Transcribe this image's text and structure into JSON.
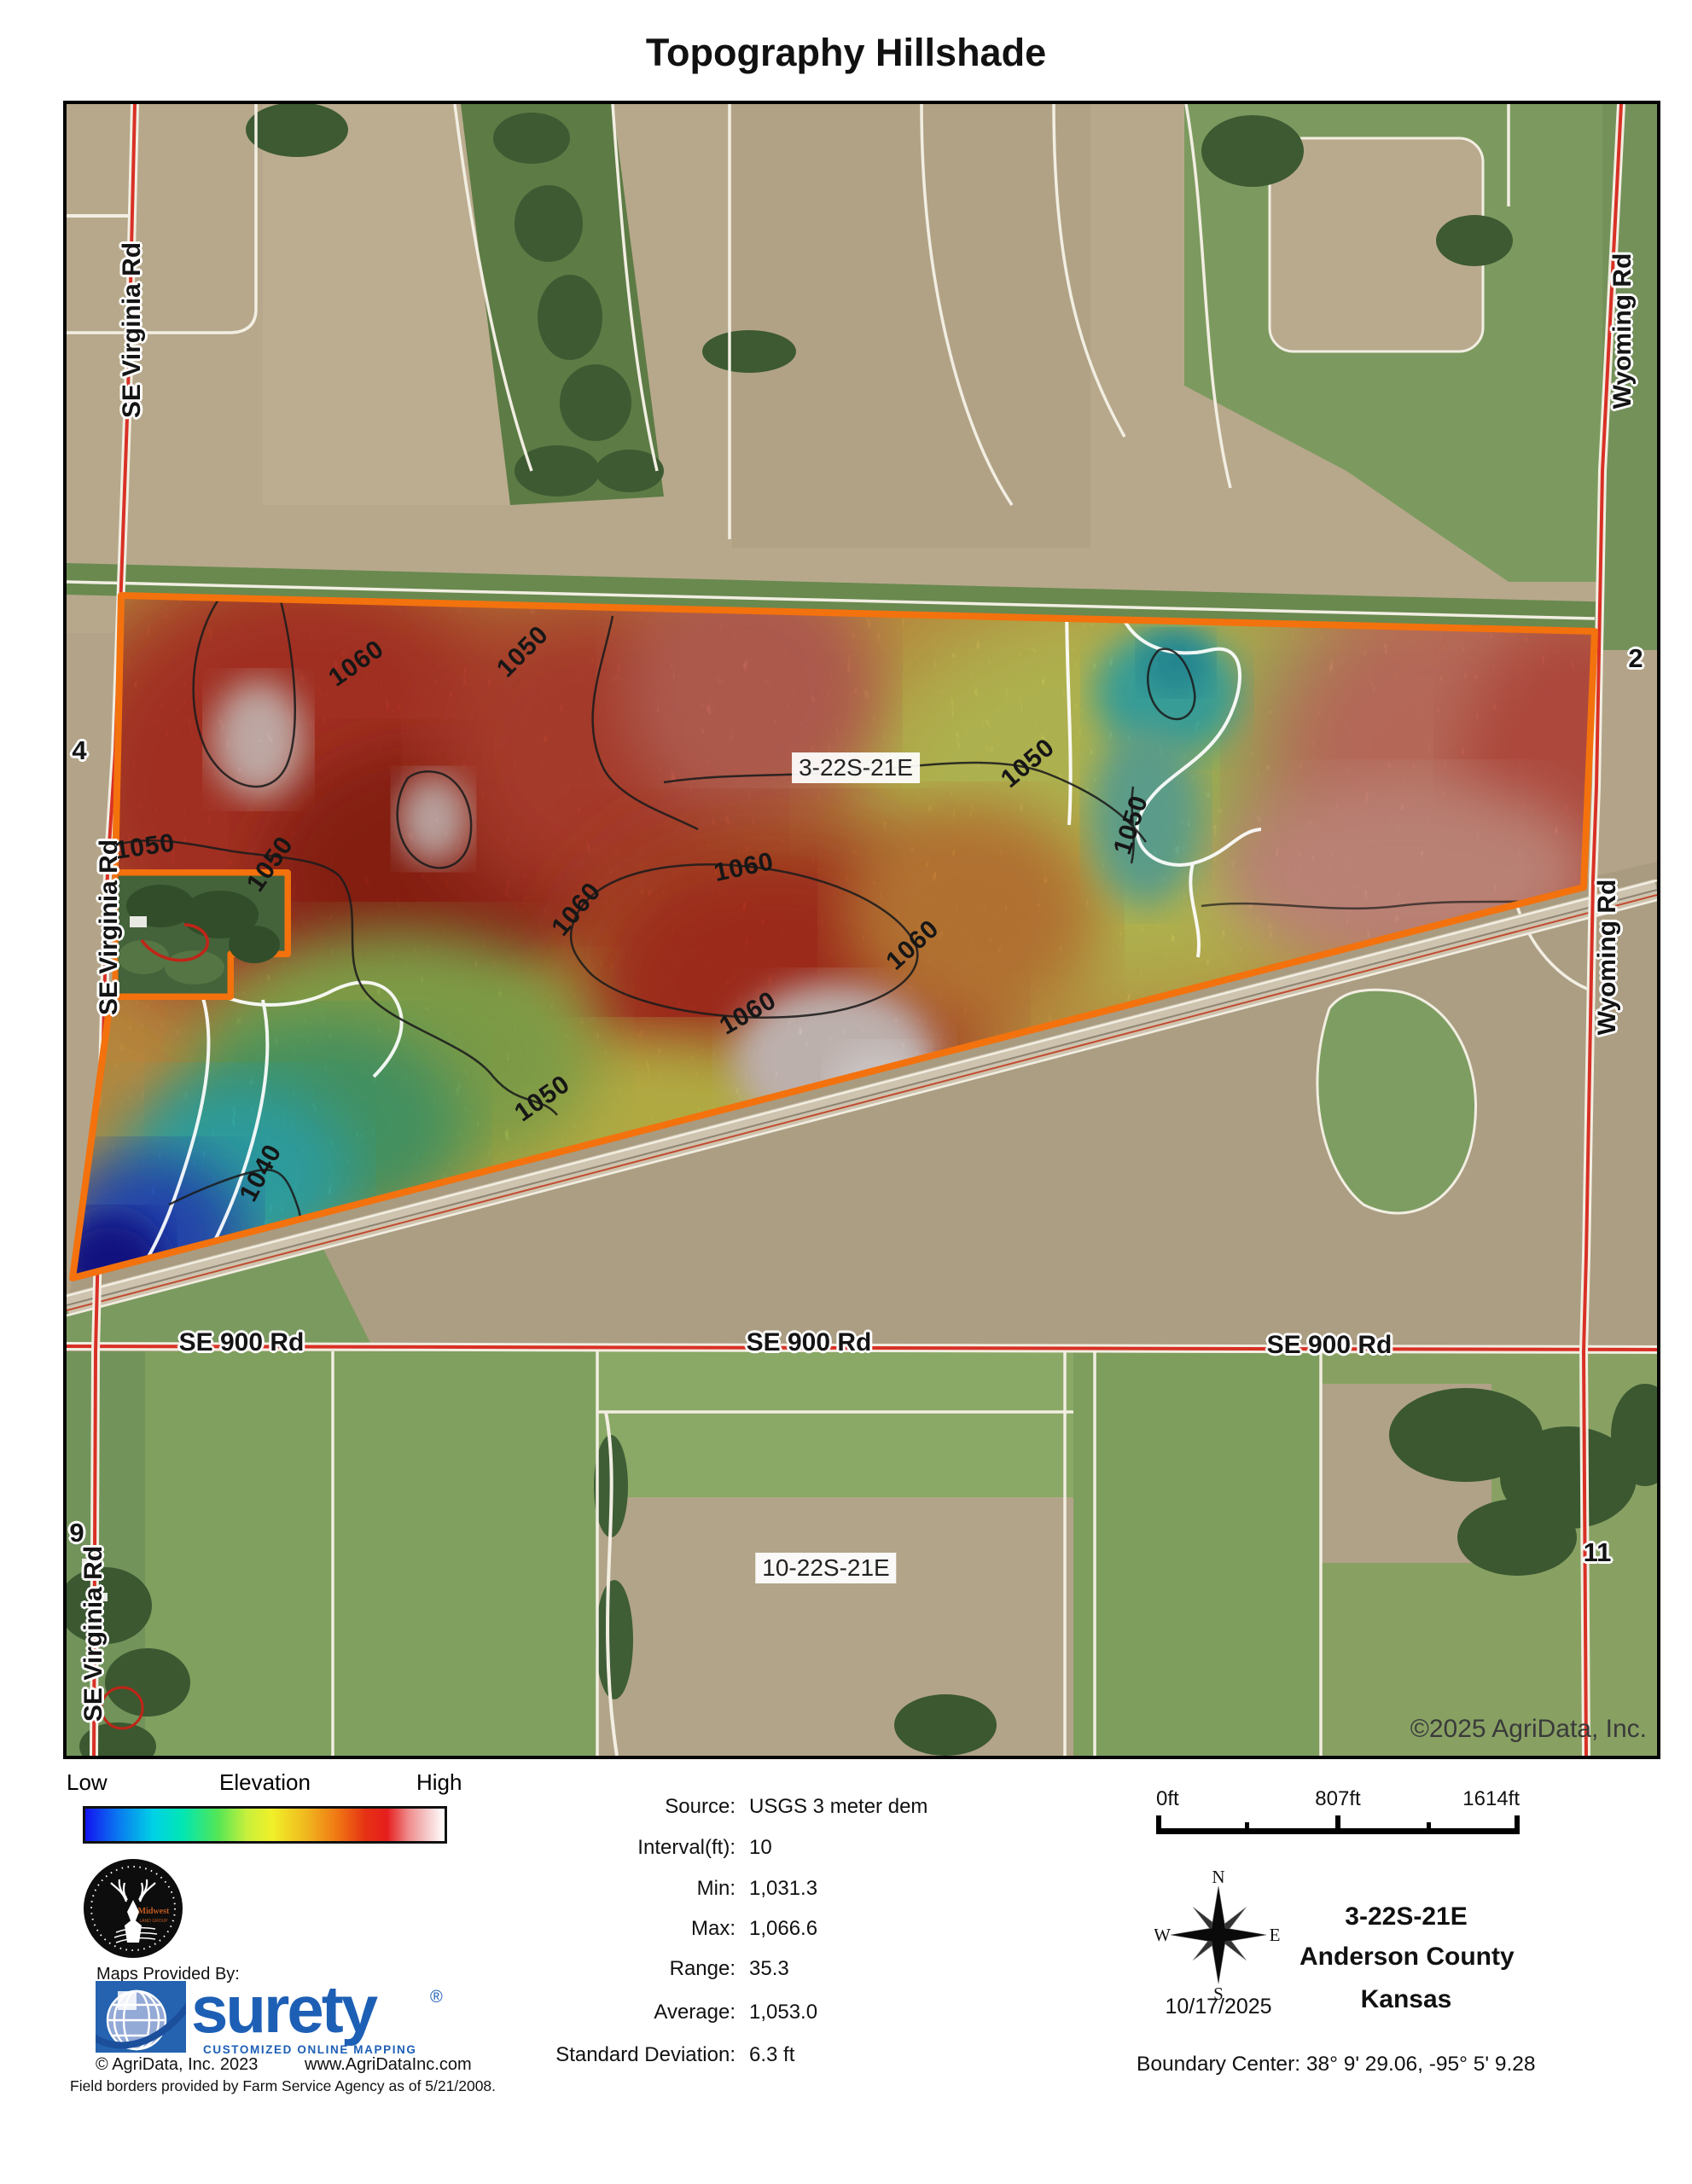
{
  "title": "Topography Hillshade",
  "map": {
    "roads": {
      "se_virginia": "SE Virginia Rd",
      "wyoming": "Wyoming Rd",
      "se900": "SE 900 Rd"
    },
    "section_labels": [
      "4",
      "2",
      "9",
      "11"
    ],
    "trs_labels": [
      "3-22S-21E",
      "10-22S-21E"
    ],
    "contour_labels": [
      "1050",
      "1050",
      "1050",
      "1060",
      "1050",
      "1050",
      "1060",
      "1060",
      "1060",
      "1060",
      "1050",
      "1040"
    ],
    "copyright": "©2025 AgriData, Inc."
  },
  "legend": {
    "low": "Low",
    "title": "Elevation",
    "high": "High"
  },
  "stats": {
    "rows": [
      {
        "label": "Source:",
        "value": "USGS 3 meter dem"
      },
      {
        "label": "Interval(ft):",
        "value": "10"
      },
      {
        "label": "Min:",
        "value": "1,031.3"
      },
      {
        "label": "Max:",
        "value": "1,066.6"
      },
      {
        "label": "Range:",
        "value": "35.3"
      },
      {
        "label": "Average:",
        "value": "1,053.0"
      },
      {
        "label": "Standard Deviation:",
        "value": "6.3 ft"
      }
    ]
  },
  "scalebar": {
    "start": "0ft",
    "mid": "807ft",
    "end": "1614ft"
  },
  "compass": {
    "n": "N",
    "e": "E",
    "s": "S",
    "w": "W",
    "date": "10/17/2025"
  },
  "location": {
    "trs": "3-22S-21E",
    "county": "Anderson County",
    "state": "Kansas",
    "boundary_center": "Boundary Center: 38° 9' 29.06,  -95° 5' 9.28"
  },
  "footer": {
    "maps_provided_by": "Maps Provided By:",
    "brand": "surety",
    "registered": "®",
    "tagline": "CUSTOMIZED ONLINE MAPPING",
    "copyright": "© AgriData, Inc. 2023",
    "website": "www.AgriDataInc.com",
    "disclaimer": "Field borders provided by Farm Service Agency as of 5/21/2008.",
    "logo_midwest": "Midwest",
    "logo_land_group": "LAND GROUP"
  },
  "colors": {
    "boundary_orange": "#F3720D",
    "road_red": "#D93025",
    "surety_blue": "#1D5FB5",
    "elevation_low": "#1414F0",
    "elevation_high": "#FFFFFF"
  }
}
